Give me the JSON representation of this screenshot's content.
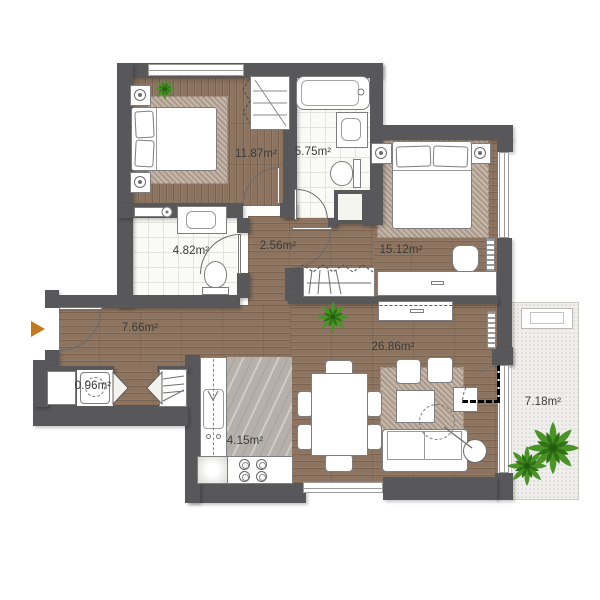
{
  "rooms": [
    {
      "name": "bedroom-1",
      "area": "11.87m²"
    },
    {
      "name": "bathroom-main",
      "area": "5.75m²"
    },
    {
      "name": "bedroom-2",
      "area": "15.12m²"
    },
    {
      "name": "bathroom-2",
      "area": "4.82m²"
    },
    {
      "name": "hallway",
      "area": "2.56m²"
    },
    {
      "name": "entry-hall",
      "area": "7.66m²"
    },
    {
      "name": "storage",
      "area": "0.96m²"
    },
    {
      "name": "living-dining",
      "area": "26.86m²"
    },
    {
      "name": "kitchen",
      "area": "4.15m²"
    },
    {
      "name": "balcony",
      "area": "7.18m²"
    }
  ],
  "icons": {
    "entrance_arrow": "right-pointing-triangle",
    "plant": "top-view-plant-starburst"
  },
  "colors": {
    "wall": "#58585a",
    "wood": "#8c7460",
    "tile": "#fafaf7",
    "kitchen": "#b6b0ab",
    "balcony": "#f0efec",
    "rug": "#b8a899",
    "plant": "#4a9427",
    "arrow": "#c2791f",
    "text": "#3b3b3b"
  }
}
